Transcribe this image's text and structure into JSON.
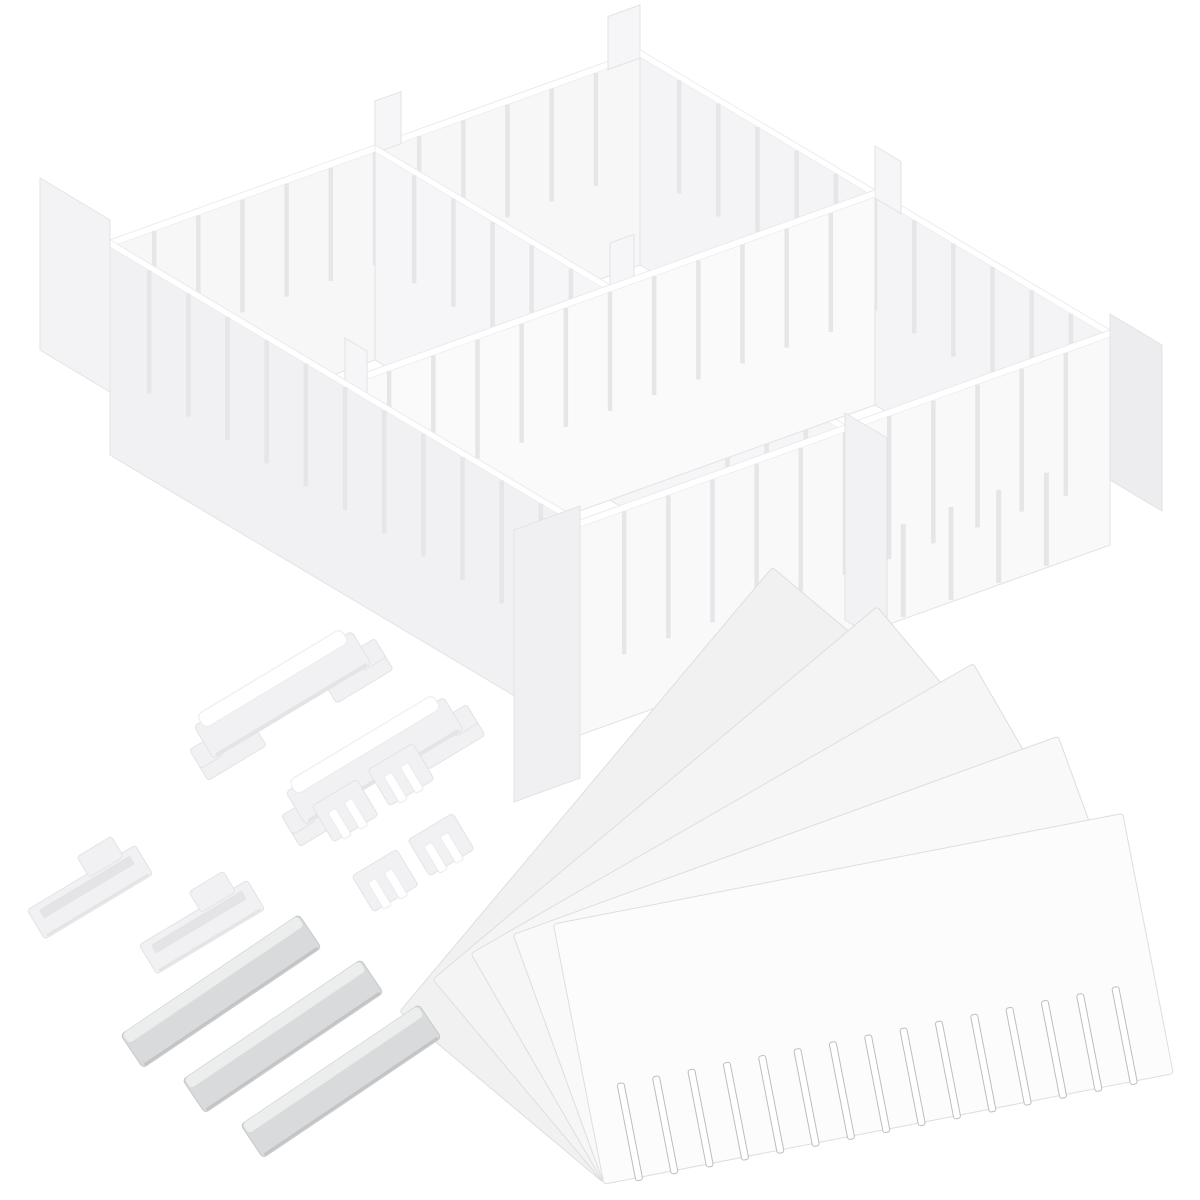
{
  "image": {
    "subject": "White adjustable plastic drawer divider organizer set on a white background",
    "background": "#ffffff"
  },
  "palette": {
    "background": "#ffffff",
    "panel_white": "#fcfcfd",
    "panel_light": "#f7f7f8",
    "panel_mid": "#f4f4f6",
    "panel_shade": "#f1f1f3",
    "edge": "#e3e3e5",
    "edge_soft": "#ebebed",
    "slot": "#e6e6e9",
    "slot_dark": "#bdbdbf",
    "clip_fill": "#f1f1f3",
    "clip_shade": "#e4e4e6",
    "strip_fill": "#d9dadb",
    "strip_bevel": "#eceded",
    "strip_edge": "#c7c8c9",
    "highlight": "#ffffff"
  },
  "assembled_grid": {
    "compartments_visible": 4,
    "long_walls": 3,
    "cross_walls": 3,
    "slots_per_wall": 11,
    "front_bottom_slots": 5,
    "corner_tabs": 4,
    "joint_tabs": 6
  },
  "connectors": {
    "rail_clips": 2,
    "tee_clips": 2,
    "small_clips": 4
  },
  "strips": {
    "count": 3
  },
  "fan": {
    "panels": 5,
    "slots_per_panel": 15
  }
}
